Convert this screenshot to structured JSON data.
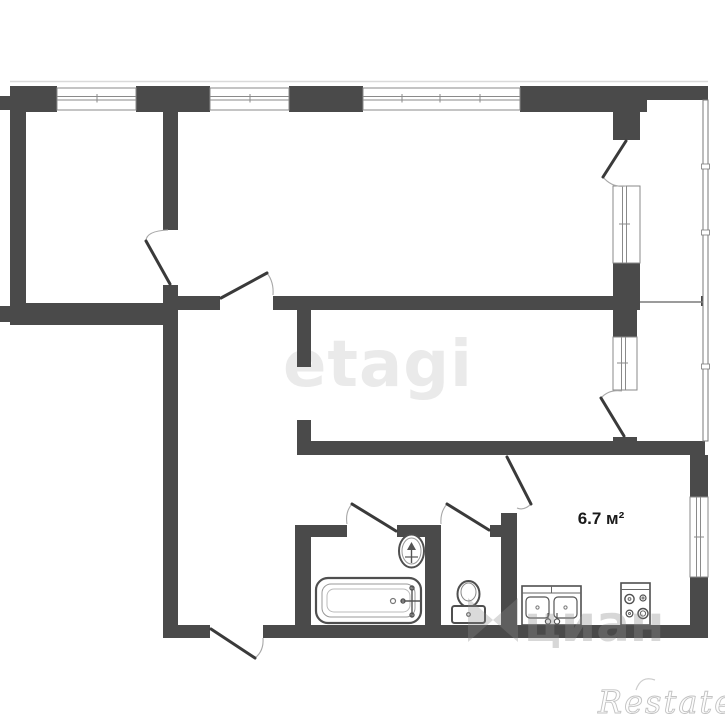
{
  "floor_plan": {
    "kitchen_area_label": "6.7 м²",
    "watermarks": {
      "etagi": "etagi",
      "cian": "циан",
      "restate": "Restate"
    },
    "colors": {
      "background": "#ffffff",
      "wall": "#4a4a4a",
      "window_frame": "#8a8a8a",
      "balcony_line": "#7a7a7a",
      "door_leaf": "#3a3a3a",
      "door_arc": "#a8a8a8",
      "fixture": "#4f4f4f",
      "area_label_color": "#1a1a1a",
      "etagi_color": "#eaeaea"
    }
  }
}
